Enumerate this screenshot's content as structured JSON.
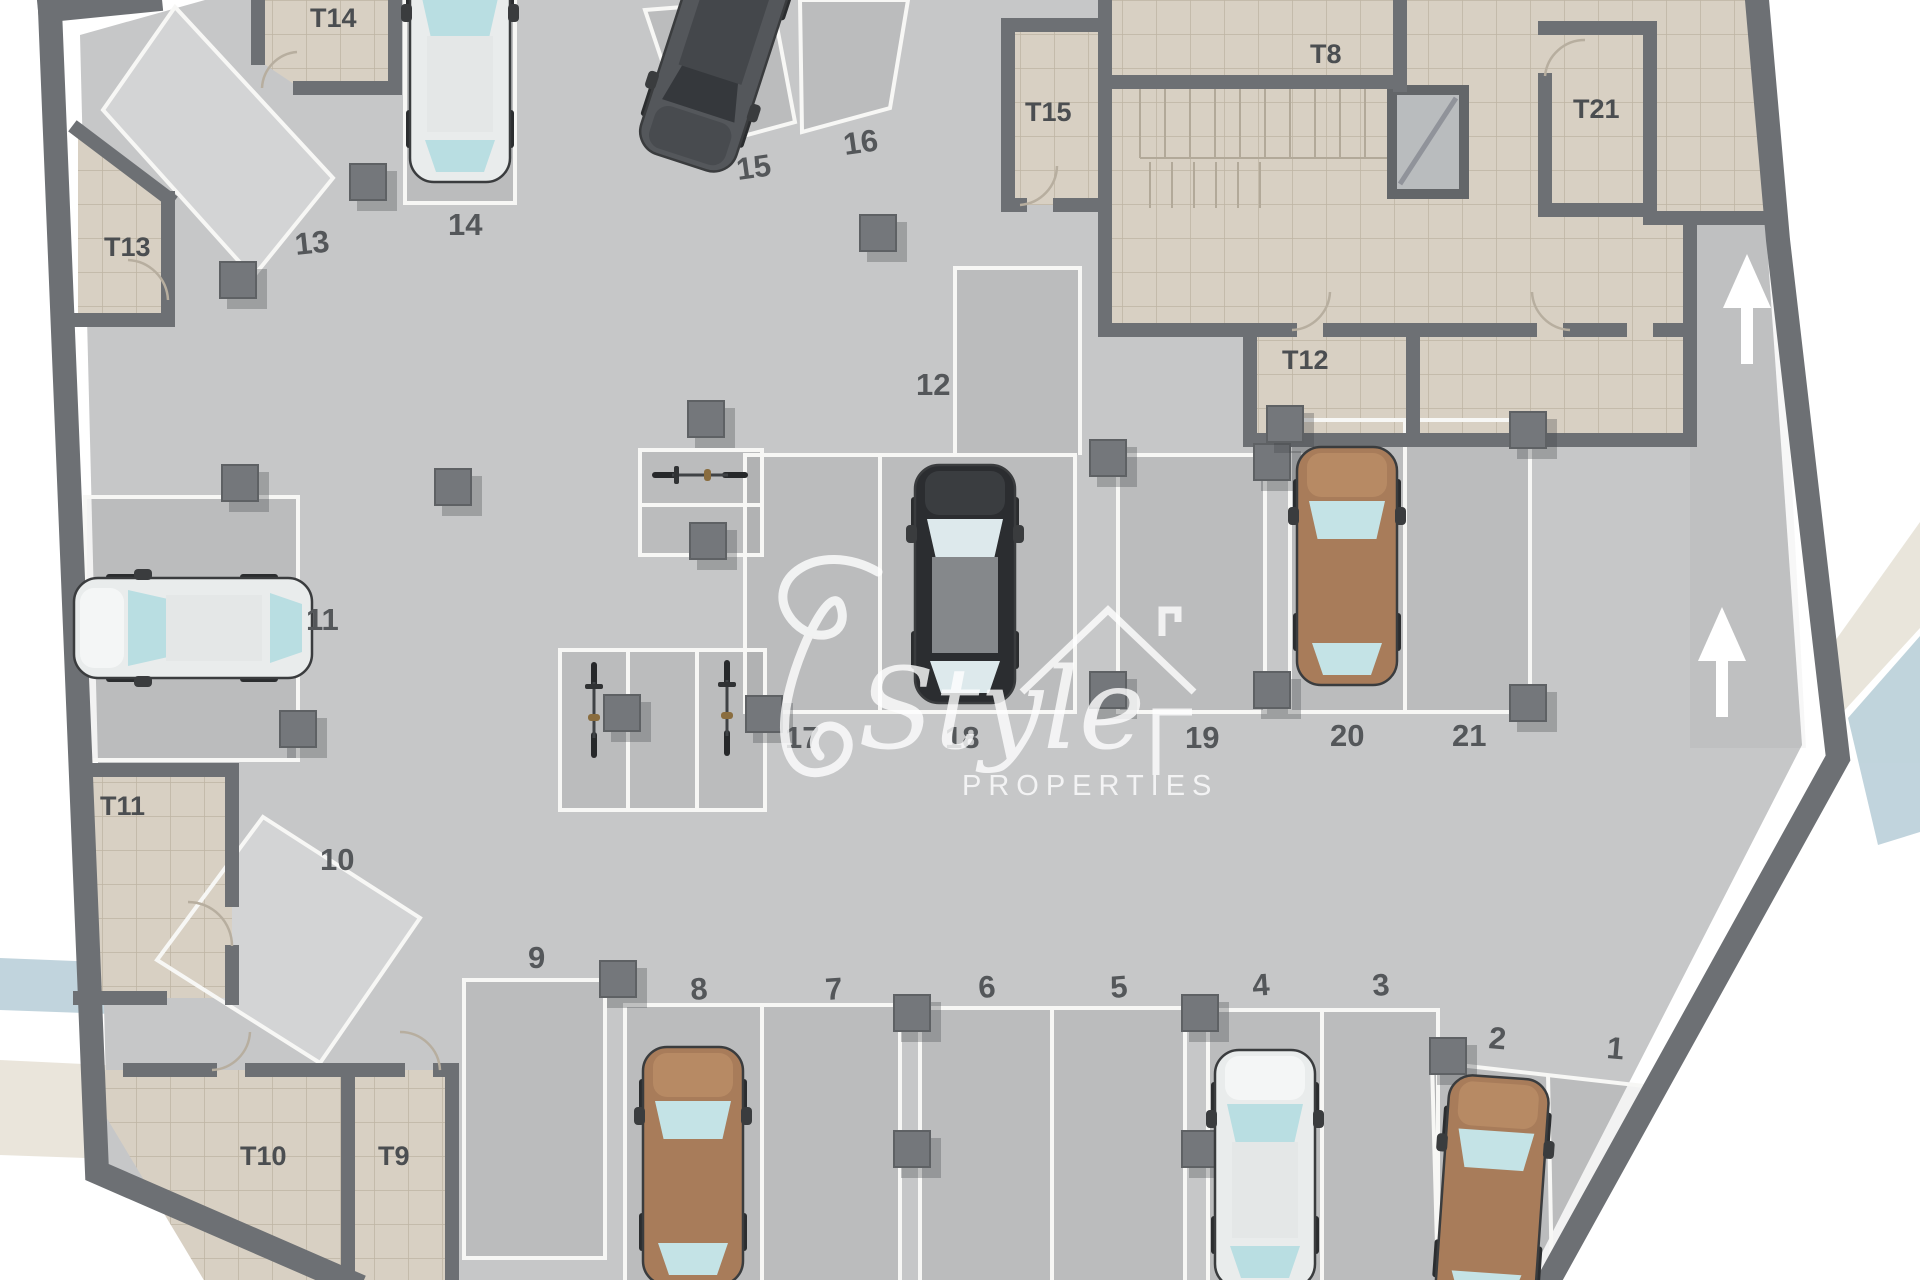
{
  "plan": {
    "title_hint": "underground parking level floor plan",
    "watermark": {
      "script": "Style",
      "caption": "PROPERTIES"
    },
    "spaces": {
      "s1": {
        "label": "1",
        "status": "empty"
      },
      "s2": {
        "label": "2",
        "status": "occupied",
        "vehicle": "car",
        "vehicle_color": "brown"
      },
      "s3": {
        "label": "3",
        "status": "empty"
      },
      "s4": {
        "label": "4",
        "status": "occupied",
        "vehicle": "car",
        "vehicle_color": "white"
      },
      "s5": {
        "label": "5",
        "status": "empty"
      },
      "s6": {
        "label": "6",
        "status": "empty"
      },
      "s7": {
        "label": "7",
        "status": "empty"
      },
      "s8": {
        "label": "8",
        "status": "occupied",
        "vehicle": "car",
        "vehicle_color": "brown"
      },
      "s9": {
        "label": "9",
        "status": "empty"
      },
      "s10": {
        "label": "10",
        "status": "empty"
      },
      "s11": {
        "label": "11",
        "status": "occupied",
        "vehicle": "car",
        "vehicle_color": "white-teal"
      },
      "s12": {
        "label": "12",
        "status": "empty"
      },
      "s13": {
        "label": "13",
        "status": "empty"
      },
      "s14": {
        "label": "14",
        "status": "occupied",
        "vehicle": "car",
        "vehicle_color": "white-teal"
      },
      "s15": {
        "label": "15",
        "status": "occupied",
        "vehicle": "van",
        "vehicle_color": "dark-gray"
      },
      "s16": {
        "label": "16",
        "status": "empty"
      },
      "s17": {
        "label": "17",
        "status": "empty"
      },
      "s18": {
        "label": "18",
        "status": "occupied",
        "vehicle": "car",
        "vehicle_color": "black"
      },
      "s19": {
        "label": "19",
        "status": "empty"
      },
      "s20": {
        "label": "20",
        "status": "occupied",
        "vehicle": "car",
        "vehicle_color": "brown"
      },
      "s21": {
        "label": "21",
        "status": "empty"
      }
    },
    "rooms": {
      "t8": {
        "label": "T8"
      },
      "t9": {
        "label": "T9"
      },
      "t10": {
        "label": "T10"
      },
      "t11": {
        "label": "T11"
      },
      "t12": {
        "label": "T12"
      },
      "t13": {
        "label": "T13"
      },
      "t14": {
        "label": "T14"
      },
      "t15": {
        "label": "T15"
      },
      "t21": {
        "label": "T21"
      }
    },
    "features": {
      "ramp_up_arrows": 2,
      "elevator": true,
      "staircase": true,
      "motorcycle_bays": {
        "upper_group_cells": 2,
        "lower_group_cells": 3,
        "motorcycles_parked": 3
      },
      "columns": true
    },
    "colors": {
      "floor": "#c6c7c8",
      "walls": "#6d7074",
      "storage_rooms": "#d8d0c3",
      "slot_lines": "#f7f7f5",
      "labels": "#54575a",
      "band_blue": "#b6cdd7",
      "band_beige": "#e6e1d5",
      "car_brown": "#a87c5a",
      "car_black": "#2b2d30",
      "car_white": "#e9ecec",
      "van_gray": "#54575b"
    }
  }
}
